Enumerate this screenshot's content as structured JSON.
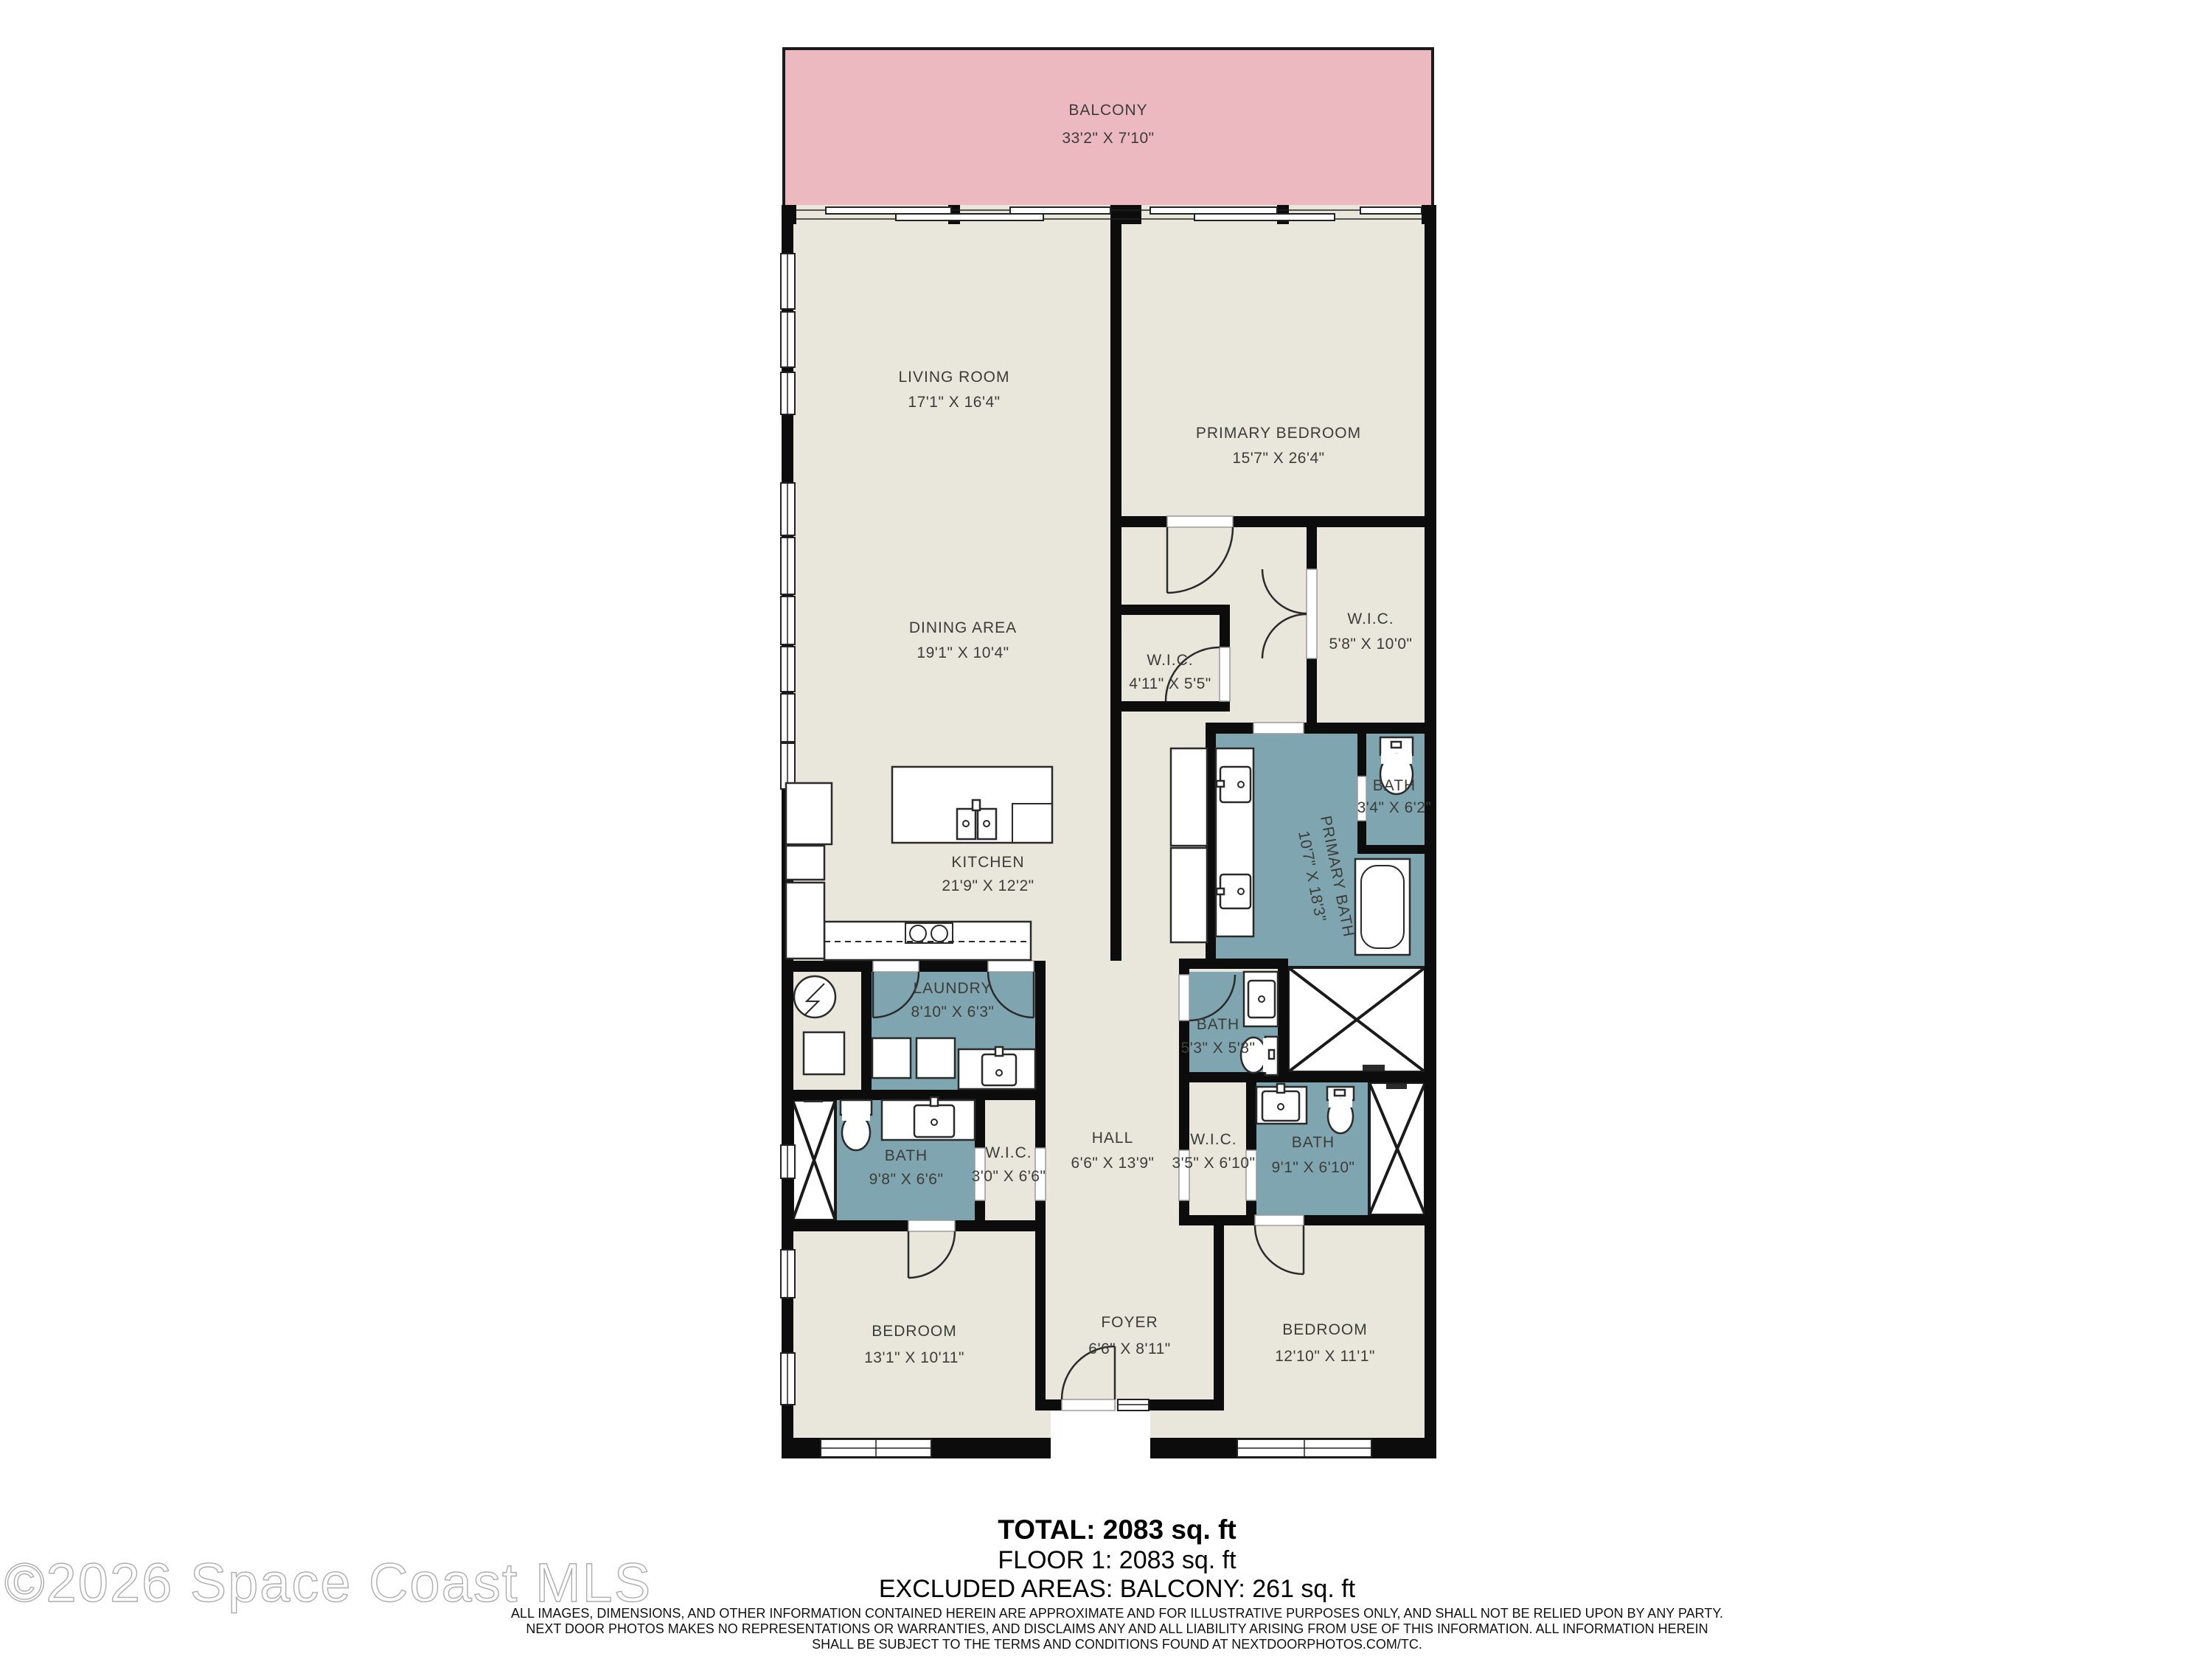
{
  "watermark": "©2026 Space Coast MLS",
  "colors": {
    "balcony": "#ecb9c0",
    "room": "#e9e7dc",
    "bath": "#7fa6b0",
    "wall": "#0c0c0c",
    "label": "#3c3c38"
  },
  "rooms": {
    "balcony": {
      "name": "BALCONY",
      "dims": "33'2\" X 7'10\""
    },
    "living_room": {
      "name": "LIVING ROOM",
      "dims": "17'1\" X 16'4\""
    },
    "primary_bedroom": {
      "name": "PRIMARY BEDROOM",
      "dims": "15'7\" X 26'4\""
    },
    "dining_area": {
      "name": "DINING AREA",
      "dims": "19'1\" X 10'4\""
    },
    "wic_primary_small": {
      "name": "W.I.C.",
      "dims": "4'11\" X 5'5\""
    },
    "wic_primary_large": {
      "name": "W.I.C.",
      "dims": "5'8\" X 10'0\""
    },
    "kitchen": {
      "name": "KITCHEN",
      "dims": "21'9\" X 12'2\""
    },
    "primary_bath": {
      "name": "PRIMARY BATH",
      "dims": "10'7\" X 18'3\""
    },
    "bath_wc": {
      "name": "BATH",
      "dims": "3'4\" X 6'2\""
    },
    "laundry": {
      "name": "LAUNDRY",
      "dims": "8'10\" X 6'3\""
    },
    "bath_hall": {
      "name": "BATH",
      "dims": "5'3\" X 5'8\""
    },
    "hall": {
      "name": "HALL",
      "dims": "6'6\" X 13'9\""
    },
    "bath_left": {
      "name": "BATH",
      "dims": "9'8\" X 6'6\""
    },
    "wic_left": {
      "name": "W.I.C.",
      "dims": "3'0\" X 6'6\""
    },
    "wic_right": {
      "name": "W.I.C.",
      "dims": "3'5\" X 6'10\""
    },
    "bath_right": {
      "name": "BATH",
      "dims": "9'1\" X 6'10\""
    },
    "bedroom_left": {
      "name": "BEDROOM",
      "dims": "13'1\" X 10'11\""
    },
    "foyer": {
      "name": "FOYER",
      "dims": "6'6\" X 8'11\""
    },
    "bedroom_right": {
      "name": "BEDROOM",
      "dims": "12'10\" X 11'1\""
    }
  },
  "footer": {
    "total": "TOTAL: 2083 sq. ft",
    "floor": "FLOOR 1: 2083 sq. ft",
    "excluded": "EXCLUDED AREAS: BALCONY: 261 sq. ft",
    "disclaimer1": "ALL IMAGES, DIMENSIONS, AND OTHER INFORMATION CONTAINED HEREIN ARE APPROXIMATE AND FOR ILLUSTRATIVE PURPOSES ONLY, AND SHALL NOT BE RELIED UPON BY ANY PARTY.",
    "disclaimer2": "NEXT DOOR PHOTOS MAKES NO REPRESENTATIONS OR WARRANTIES, AND DISCLAIMS ANY AND ALL LIABILITY ARISING FROM USE OF THIS INFORMATION. ALL INFORMATION HEREIN",
    "disclaimer3": "SHALL BE SUBJECT TO THE TERMS AND CONDITIONS FOUND AT NEXTDOORPHOTOS.COM/TC."
  }
}
